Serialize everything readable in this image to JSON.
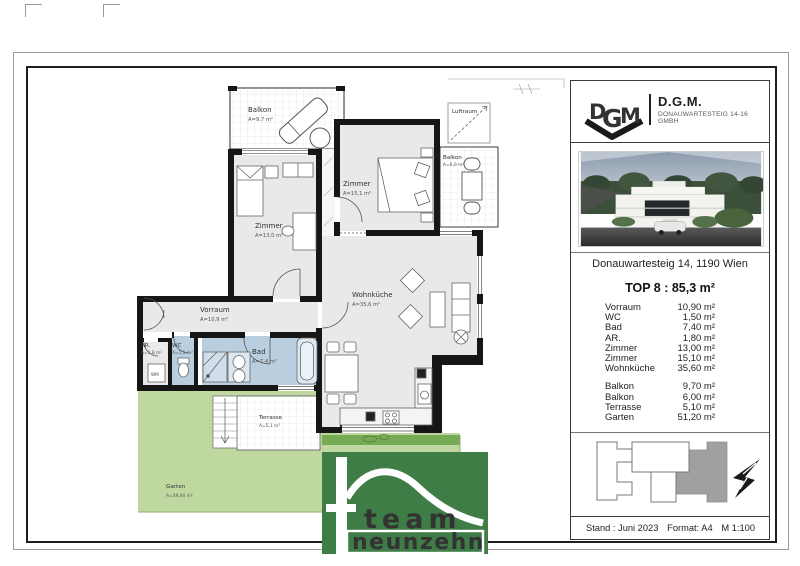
{
  "plan": {
    "labels": {
      "balkon1": {
        "name": "Balkon",
        "area": "A=9,7 m²"
      },
      "zimmer1": {
        "name": "Zimmer",
        "area": "A=13,0 m²"
      },
      "zimmer2": {
        "name": "Zimmer",
        "area": "A=15,1 m²"
      },
      "luftraum": {
        "name": "Luftraum"
      },
      "balkon2": {
        "name": "Balkon",
        "area": "A=6,0 m²"
      },
      "wohnkueche": {
        "name": "Wohnküche",
        "area": "A=35,6 m²"
      },
      "vorraum": {
        "name": "Vorraum",
        "area": "A=10,9 m²"
      },
      "ar": {
        "name": "AR.",
        "area": "A=1,8 m²"
      },
      "wc": {
        "name": "WC",
        "area": "A=1,5 m²"
      },
      "bad": {
        "name": "Bad",
        "area": "A=7,4 m²"
      },
      "terrasse": {
        "name": "Terrasse",
        "area": "A=5,1 m²"
      },
      "garten": {
        "name": "Garten",
        "area": "A=39,40 m²"
      },
      "wm": "WM"
    },
    "colors": {
      "floor": "#e9e9e9",
      "wall": "#161616",
      "bath_blue": "#b9cede",
      "garden_green": "#bfd8a0",
      "hedge_green": "#77aa55"
    }
  },
  "panel": {
    "company": {
      "logo_letters": [
        "D",
        "G",
        "M"
      ],
      "name": "D.G.M.",
      "subtitle": "DONAUWARTESTEIG 14-16 GMBH"
    },
    "address": "Donauwartesteig 14, 1190 Wien",
    "unit_title": "TOP 8 : 85,3 m²",
    "interior": [
      {
        "label": "Vorraum",
        "value": "10,90 m²"
      },
      {
        "label": "WC",
        "value": "1,50 m²"
      },
      {
        "label": "Bad",
        "value": "7,40 m²"
      },
      {
        "label": "AR.",
        "value": "1,80 m²"
      },
      {
        "label": "Zimmer",
        "value": "13,00 m²"
      },
      {
        "label": "Zimmer",
        "value": "15,10 m²"
      },
      {
        "label": "Wohnküche",
        "value": "35,60 m²"
      }
    ],
    "outdoor": [
      {
        "label": "Balkon",
        "value": "9,70 m²"
      },
      {
        "label": "Balkon",
        "value": "6,00 m²"
      },
      {
        "label": "Terrasse",
        "value": "5,10 m²"
      },
      {
        "label": "Garten",
        "value": "51,20 m²"
      }
    ],
    "siteplan_unit_color": "#a0a0a0",
    "footer": {
      "stand": "Stand : Juni 2023",
      "format": "Format: A4",
      "scale": "M 1:100"
    }
  },
  "brand": {
    "line1": "team",
    "line2": "neunzehn",
    "green": "#3f7d47",
    "logo_red": "#b43a2c"
  }
}
